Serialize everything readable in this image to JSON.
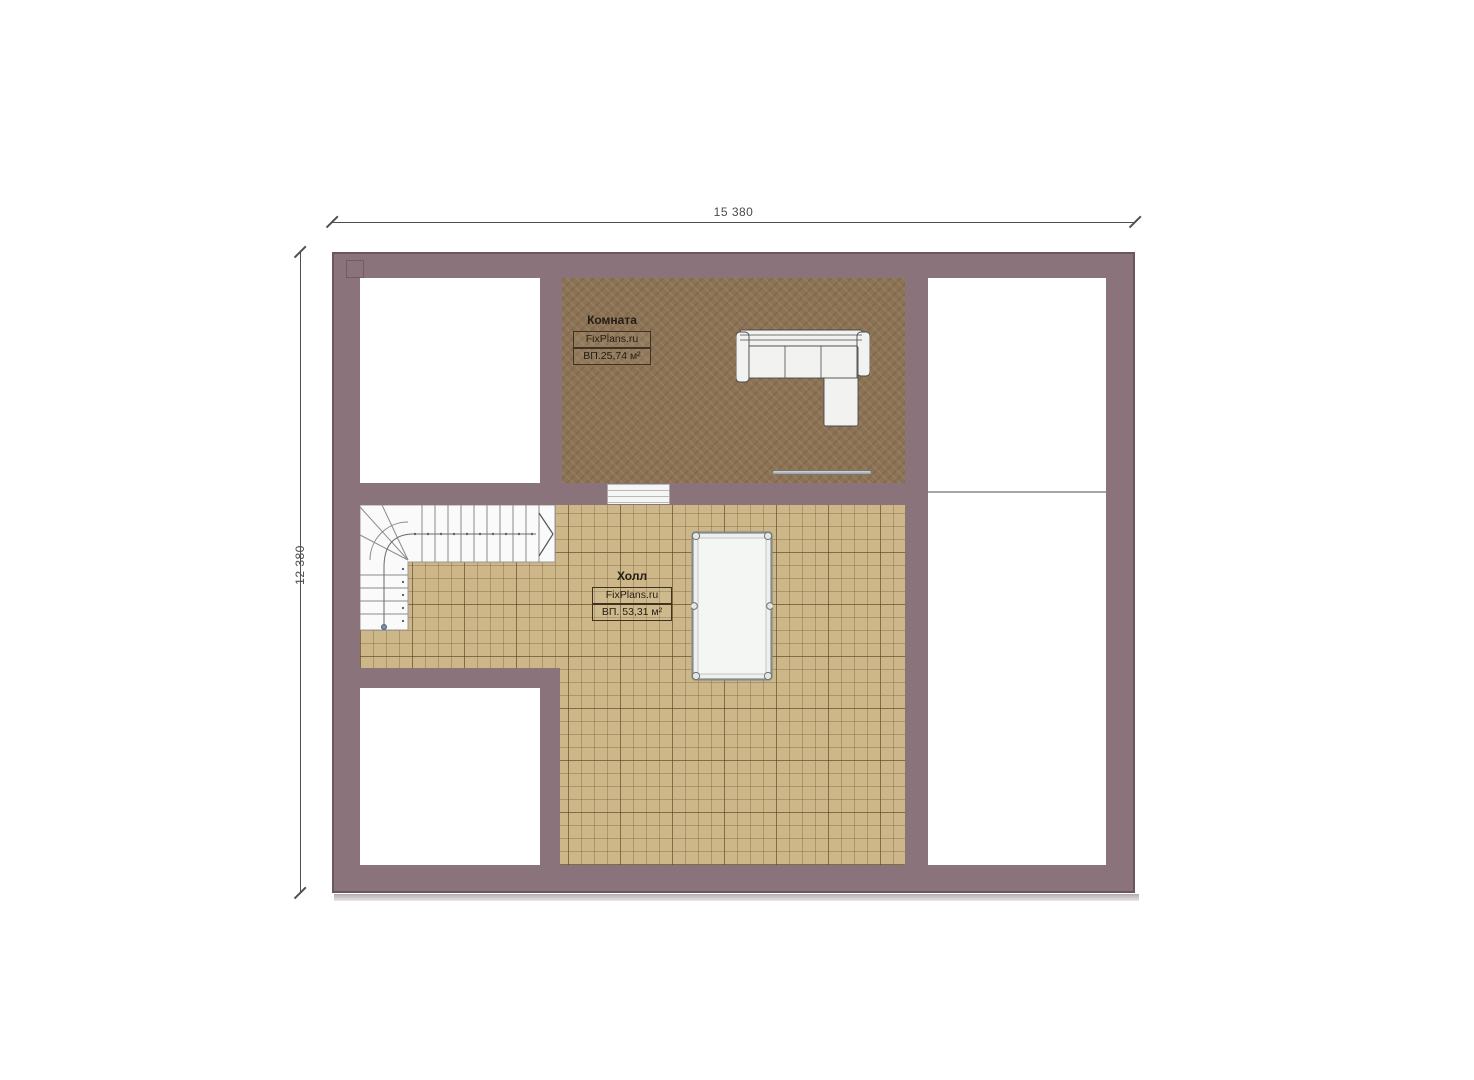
{
  "dimensions": {
    "width_label": "15 380",
    "height_label": "12 380"
  },
  "rooms": {
    "room1": {
      "name": "Комната",
      "brand": "FixPlans.ru",
      "area": "ВП.25,74 м²"
    },
    "hall": {
      "name": "Холл",
      "brand": "FixPlans.ru",
      "area": "ВП. 53,31 м²"
    }
  },
  "objects": {
    "sofa": "corner-sofa",
    "billiard_table": "billiard-table",
    "staircase": "l-shaped-staircase",
    "threshold": "door-step",
    "thin_item": "wall-mounted-thin-object"
  },
  "colors": {
    "wall": "#8a737b",
    "wall_edge": "#6a565e",
    "room_floor": "#8d7355",
    "hall_tile": "#cdb687",
    "dimension_text": "#4a4a4a"
  }
}
